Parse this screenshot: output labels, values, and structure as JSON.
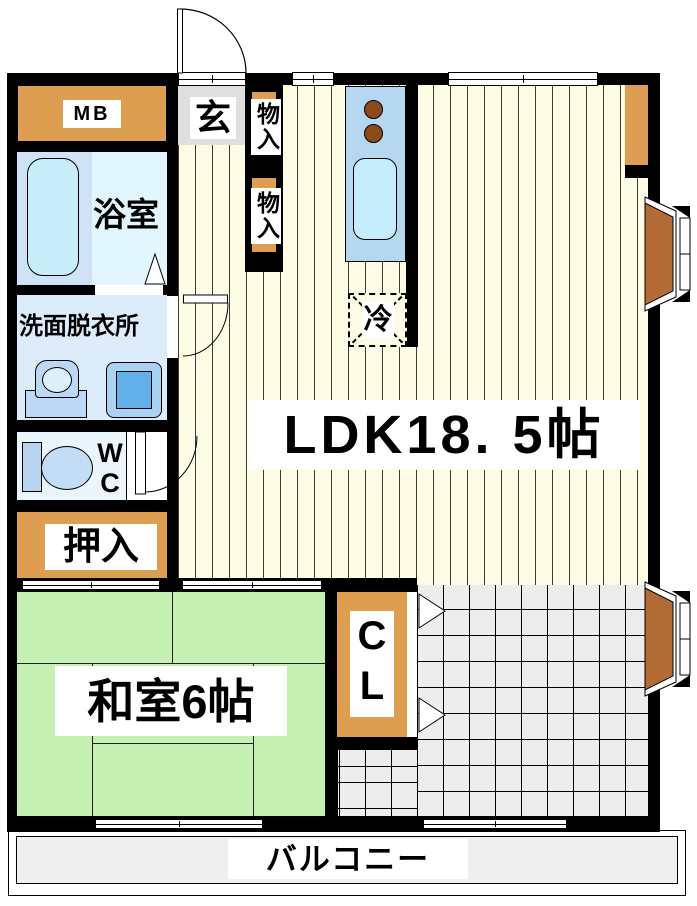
{
  "plan": {
    "type": "japanese-apartment-floor-plan",
    "labels": {
      "mb": "MB",
      "genkan": "玄",
      "storage1": "物入",
      "storage2": "物入",
      "bathroom": "浴室",
      "washroom": "洗面脱衣所",
      "wc": "WC",
      "oshiire": "押入",
      "ldk": "LDK18. 5帖",
      "refrigerator": "冷",
      "washitsu": "和室6帖",
      "closet": "CL",
      "balcony": "バルコニー"
    },
    "colors": {
      "wall": "#000000",
      "ldk_floor_cream": "#FFFCE6",
      "tatami_green": "#C6EFB3",
      "accent_orange": "#DD9E52",
      "bay_window_brown": "#B26B35",
      "bath_room_blue": "#E2F6FD",
      "bathtub_blue": "#C9EEFB",
      "washroom_blue": "#DCECFA",
      "kitchen_counter_blue": "#B5D8F0",
      "kitchen_sink_blue": "#C5EDFB",
      "burner_brown": "#8A4A1C",
      "genkan_gray": "#DFDFDF",
      "tile_gray": "#EDEDED",
      "balcony_gray": "#EFEFEF"
    }
  }
}
